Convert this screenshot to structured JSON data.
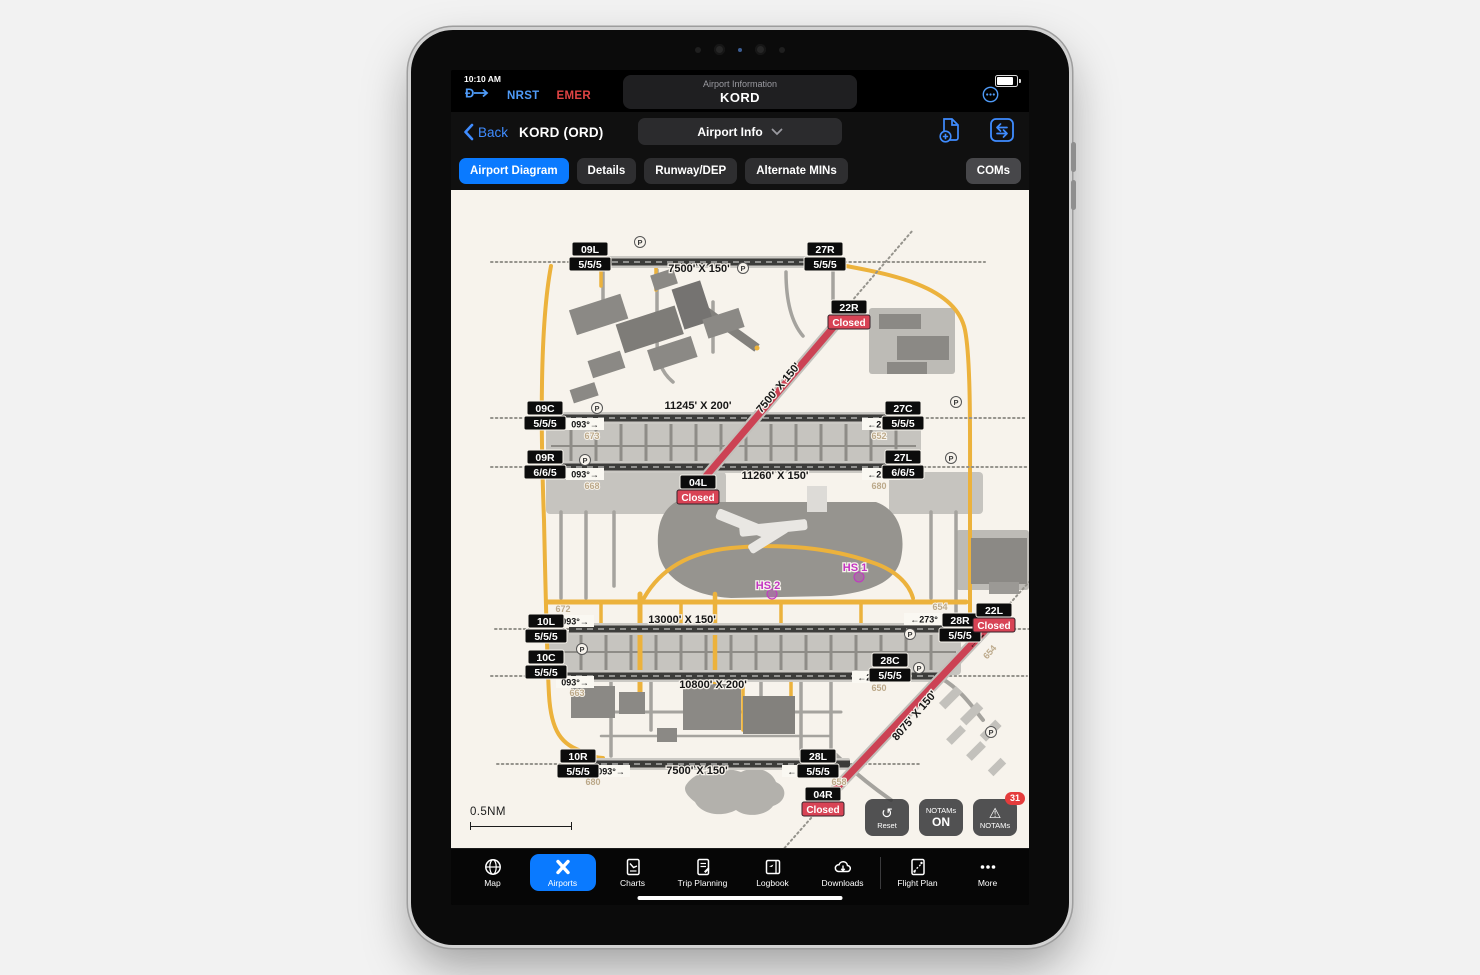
{
  "status_bar": {
    "time": "10:10 AM",
    "nrst_label": "NRST",
    "emer_label": "EMER",
    "header_title": "Airport Information",
    "header_code": "KORD"
  },
  "nav_bar": {
    "back_label": "Back",
    "airport_title": "KORD (ORD)",
    "view_selector": "Airport Info"
  },
  "tabs": {
    "airport_diagram": "Airport Diagram",
    "details": "Details",
    "runway_dep": "Runway/DEP",
    "alternate_mins": "Alternate MINs",
    "coms": "COMs"
  },
  "diagram": {
    "scale_label": "0.5NM",
    "hs1": "HS 1",
    "hs2": "HS 2",
    "p": "P",
    "runways": [
      {
        "a_id": "09L",
        "a_cond": "5/5/5",
        "b_id": "27R",
        "b_cond": "5/5/5",
        "dim": "7500' X 150'"
      },
      {
        "a_id": "09C",
        "a_cond": "5/5/5",
        "a_hdg": "093°→",
        "a_elev": "673",
        "b_id": "27C",
        "b_cond": "5/5/5",
        "b_hdg": "←273°",
        "b_elev": "652",
        "dim": "11245' X 200'"
      },
      {
        "a_id": "09R",
        "a_cond": "6/6/5",
        "a_hdg": "093°→",
        "a_elev": "668",
        "b_id": "27L",
        "b_cond": "6/6/5",
        "b_hdg": "←273°",
        "b_elev": "680",
        "dim": "11260' X 150'"
      },
      {
        "a_id": "10L",
        "a_cond": "5/5/5",
        "a_hdg": "093°→",
        "a_elev": "672",
        "b_id": "28R",
        "b_cond": "5/5/5",
        "b_hdg": "←273°",
        "b_elev": "654",
        "dim": "13000' X 150'"
      },
      {
        "a_id": "10C",
        "a_cond": "5/5/5",
        "a_hdg": "093°→",
        "a_elev": "663",
        "b_id": "28C",
        "b_cond": "5/5/5",
        "b_hdg": "←273°",
        "b_elev": "650",
        "dim": "10800' X 200'"
      },
      {
        "a_id": "10R",
        "a_cond": "5/5/5",
        "a_hdg": "093°→",
        "a_elev": "680",
        "b_id": "28L",
        "b_cond": "5/5/5",
        "b_hdg": "←273°",
        "b_elev": "658",
        "dim": "7500' X 150'"
      },
      {
        "a_id": "22R",
        "a_status": "Closed",
        "b_id": "04L",
        "b_status": "Closed",
        "dim": "7500' X 150'"
      },
      {
        "a_id": "22L",
        "a_status": "Closed",
        "a_hdg": "←22",
        "a_elev": "654",
        "b_id": "04R",
        "b_status": "Closed",
        "dim": "8075' X 150'"
      }
    ]
  },
  "map_controls": {
    "reset_label": "Reset",
    "notams_toggle_line1": "NOTAMs",
    "notams_toggle_line2": "ON",
    "notams_button_label": "NOTAMs",
    "notams_count": "31"
  },
  "tab_bar": {
    "map": "Map",
    "airports": "Airports",
    "charts": "Charts",
    "trip_planning": "Trip Planning",
    "logbook": "Logbook",
    "downloads": "Downloads",
    "flight_plan": "Flight Plan",
    "more": "More"
  },
  "colors": {
    "accent_blue": "#0a7aff",
    "closed_red": "#d84355",
    "taxiway_yellow": "#ecb23c",
    "hotspot_magenta": "#c335c3",
    "diagram_bg": "#f7f3ec"
  }
}
